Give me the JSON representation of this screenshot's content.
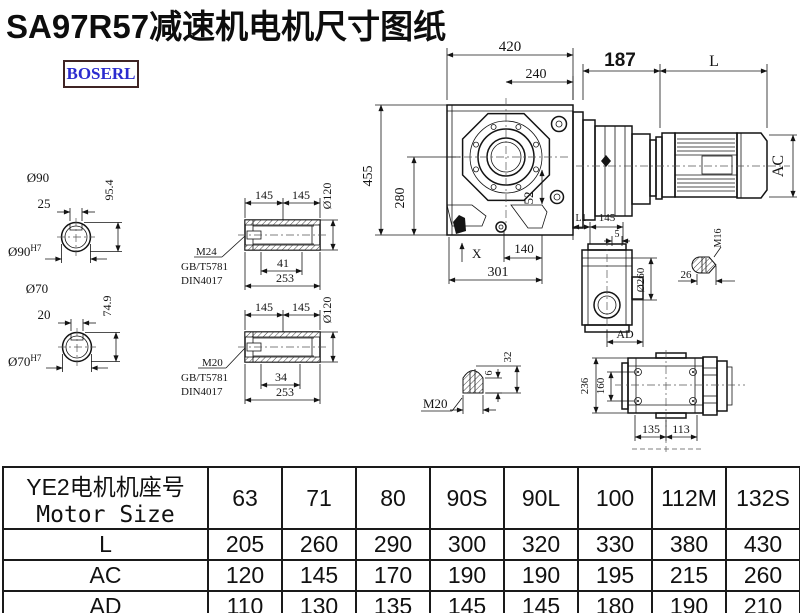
{
  "title": "SA97R57减速机电机尺寸图纸",
  "logo": "BOSERL",
  "drawing": {
    "shaft_top": {
      "dia": "Ø90",
      "key_width": "25",
      "height": "95.4",
      "fit_base": "Ø90",
      "fit_sup": "H7"
    },
    "shaft_bottom": {
      "dia": "Ø70",
      "key_width": "20",
      "height": "74.9",
      "fit_base": "Ø70",
      "fit_sup": "H7"
    },
    "sleeve_top": {
      "d145a": "145",
      "d145b": "145",
      "dia": "Ø120",
      "d41": "41",
      "d253": "253",
      "bolt": "M24",
      "std1": "GB/T5781",
      "std2": "DIN4017"
    },
    "sleeve_bottom": {
      "d145a": "145",
      "d145b": "145",
      "dia": "Ø120",
      "d34": "34",
      "d253": "253",
      "bolt": "M20",
      "std1": "GB/T5781",
      "std2": "DIN4017"
    },
    "front_view": {
      "d420": "420",
      "d240": "240",
      "d455": "455",
      "d280": "280",
      "d52": "52",
      "d140": "140",
      "d301": "301",
      "x_label": "X"
    },
    "motor": {
      "d187": "187",
      "L": "L",
      "AC": "AC"
    },
    "side_view": {
      "L1": "L1",
      "d145": "145",
      "d5": "5",
      "dia260": "Ø260",
      "AD": "AD"
    },
    "bolt_m16": {
      "label": "M16",
      "d26": "26"
    },
    "bolt_m20": {
      "label": "M20",
      "d6": "6",
      "d32": "32"
    },
    "rear_view": {
      "d236": "236",
      "d160": "160",
      "d135": "135",
      "d113": "113"
    }
  },
  "table": {
    "header_cn": "YE2电机机座号",
    "header_en": "Motor Size",
    "columns": [
      "63",
      "71",
      "80",
      "90S",
      "90L",
      "100",
      "112M",
      "132S"
    ],
    "rows": [
      {
        "label": "L",
        "values": [
          "205",
          "260",
          "290",
          "300",
          "320",
          "330",
          "380",
          "430"
        ]
      },
      {
        "label": "AC",
        "values": [
          "120",
          "145",
          "170",
          "190",
          "190",
          "195",
          "215",
          "260"
        ]
      },
      {
        "label": "AD",
        "values": [
          "110",
          "130",
          "135",
          "145",
          "145",
          "180",
          "190",
          "210"
        ]
      }
    ]
  }
}
